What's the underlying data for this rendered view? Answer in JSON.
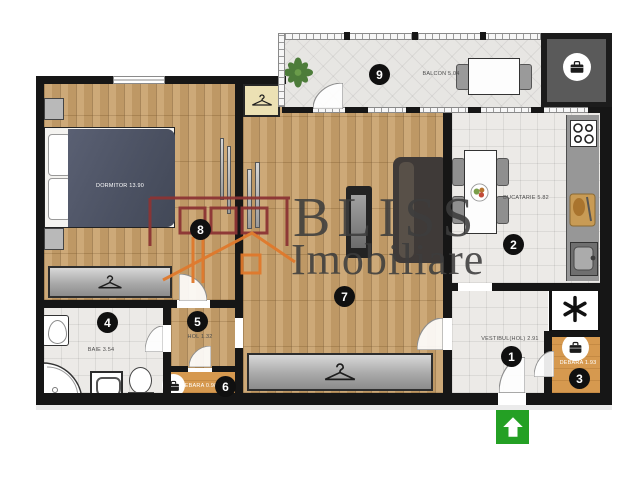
{
  "brand": {
    "name_top": "BLISS",
    "name_bottom": "Imobiliare"
  },
  "rooms": {
    "vestibul": {
      "number": "1",
      "label": "VESTIBUL(HOL) 2.91"
    },
    "bucatarie": {
      "number": "2",
      "label": "BUCATARIE 5.82"
    },
    "debara_mare": {
      "number": "3",
      "label": "DEBARA 1.93"
    },
    "baie": {
      "number": "4",
      "label": "BAIE 3.54"
    },
    "hol": {
      "number": "5",
      "label": "HOL 1.32"
    },
    "debara_mica": {
      "number": "6",
      "label": "DEBARA 0.98"
    },
    "living": {
      "number": "7"
    },
    "dormitor": {
      "number": "8",
      "label": "DORMITOR 13.90"
    },
    "balcon": {
      "number": "9",
      "label": "BALCON 5.04"
    }
  },
  "icons": {
    "wardrobe": "hanger-icon",
    "storage": "briefcase-icon",
    "utility": "asterisk-icon",
    "entrance": "arrow-up-icon",
    "plant": "plant-icon"
  },
  "colors": {
    "wall": "#161616",
    "wood_floor": "#c9a36e",
    "tile_floor": "#eceae7",
    "storage_floor": "#d6994f",
    "watermark": "#3d3d3d",
    "logo_red": "#8c3434",
    "logo_orange": "#e0792c",
    "entrance_green": "#24a024"
  }
}
